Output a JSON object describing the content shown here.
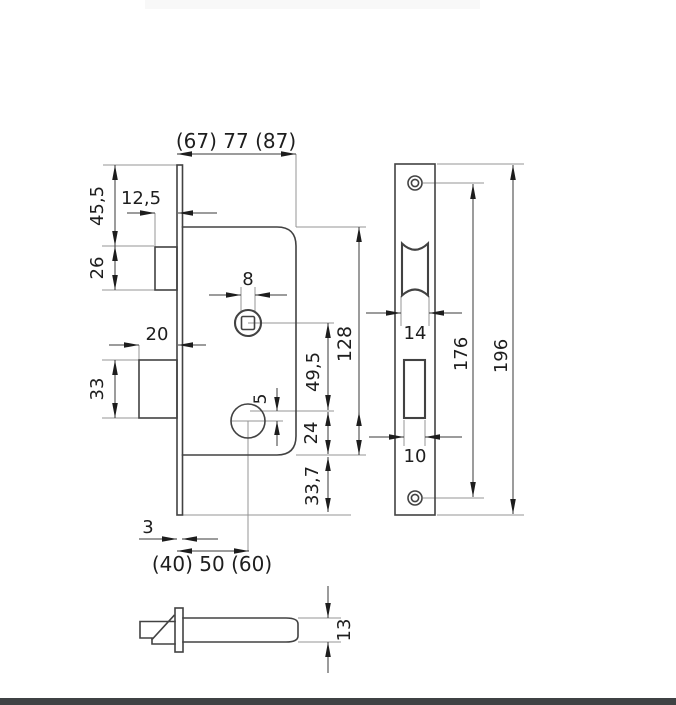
{
  "page": {
    "kind": "technical-drawing",
    "subject": "mortise lock dimensional drawing",
    "colors": {
      "outline": "#424242",
      "dimension_line": "#383838",
      "extension_line": "#949494",
      "text": "#1e1e1e",
      "header_bar": "#f8f8f8",
      "footer_bar": "#3f4244",
      "background": "#ffffff"
    }
  },
  "views": {
    "case_side_view": "lock case side view",
    "faceplate_front_view": "faceplate front view",
    "bottom_profile_view": "case bottom profile view"
  },
  "dims": {
    "case_depth": "(67) 77 (87)",
    "latch_protrusion": "12,5",
    "top_to_latch": "45,5",
    "latch_height": "26",
    "bolt_protrusion": "20",
    "bolt_height": "33",
    "spindle_square": "8",
    "spindle_to_ref": "49,5",
    "ref_to_cylinder": "5",
    "ref_to_case_bottom": "24",
    "case_to_plate_bottom": "33,7",
    "case_height": "128",
    "plate_thickness": "3",
    "backset": "(40) 50 (60)",
    "latch_cutout_width": "14",
    "bolt_cutout_width": "10",
    "screw_hole_spacing": "176",
    "plate_length": "196",
    "case_thickness": "13"
  }
}
